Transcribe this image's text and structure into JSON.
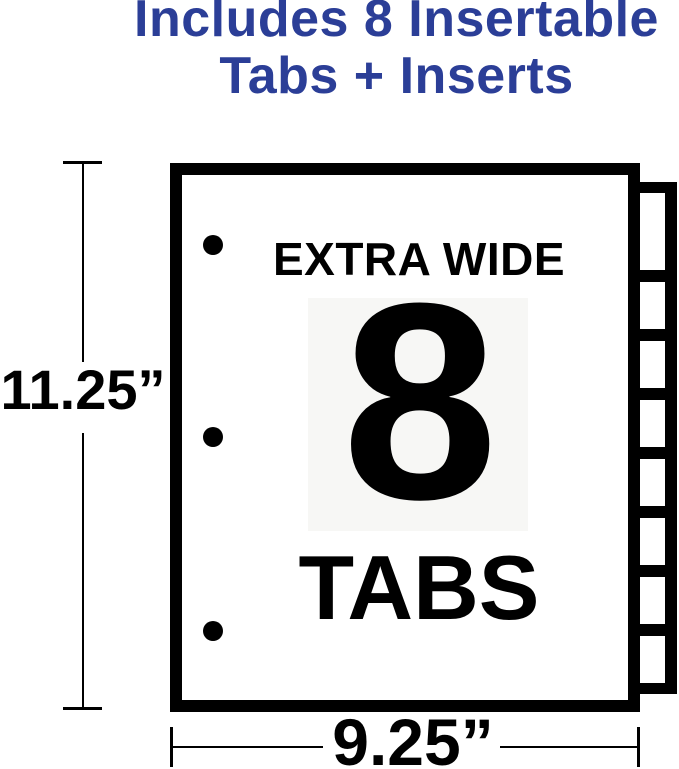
{
  "headline": {
    "line1": "Includes 8 Insertable",
    "line2": "Tabs + Inserts"
  },
  "sheet": {
    "top_label": "EXTRA WIDE",
    "tab_count_number": "8",
    "bottom_label": "TABS",
    "tabs_total": 8,
    "binder_holes": 3
  },
  "dimensions": {
    "height": "11.25”",
    "width": "9.25”"
  },
  "colors": {
    "accent-blue": "#2b3e97",
    "ink": "#000000",
    "panel-gray": "#f7f7f5",
    "paper-white": "#ffffff"
  }
}
